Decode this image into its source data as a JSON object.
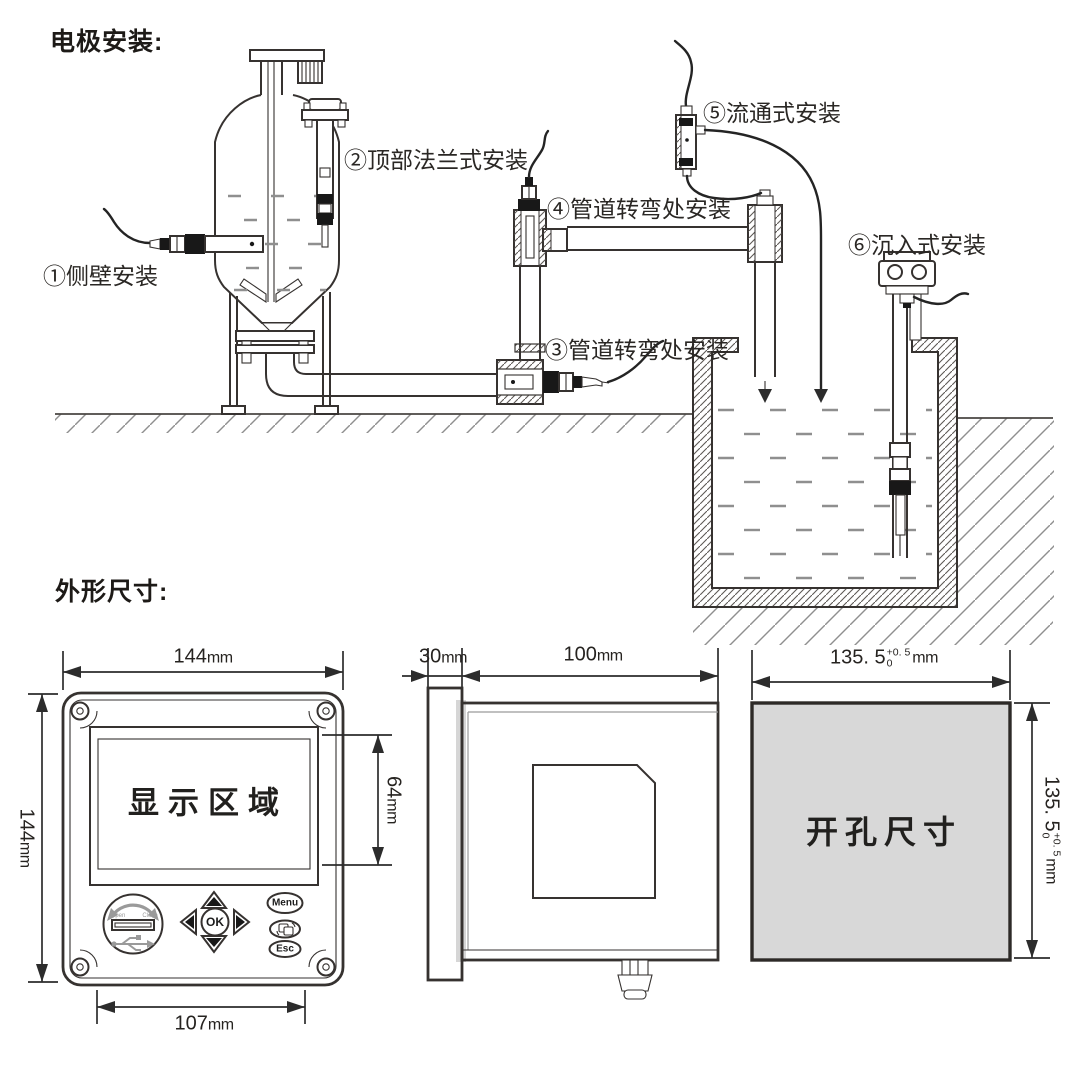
{
  "sections": {
    "electrode_title": "电极安装:",
    "dimensions_title": "外形尺寸:"
  },
  "installation": {
    "labels": {
      "side_wall": "①侧壁安装",
      "top_flange": "②顶部法兰式安装",
      "pipe_bend_lower": "③管道转弯处安装",
      "pipe_bend_upper": "④管道转弯处安装",
      "flow_through": "⑤流通式安装",
      "submersion": "⑥沉入式安装"
    }
  },
  "front_view": {
    "display_label": "显示区域",
    "dims": {
      "width": "144",
      "height": "144",
      "display_height": "64",
      "keypad_width": "107",
      "unit": "mm"
    },
    "buttons": {
      "menu": "Menu",
      "esc": "Esc",
      "ok": "OK"
    },
    "usb": {
      "open": "Open",
      "close": "Close"
    }
  },
  "side_view": {
    "dims": {
      "bezel_depth": "30",
      "body_depth": "100",
      "unit": "mm"
    }
  },
  "cutout_view": {
    "label": "开孔尺寸",
    "dims": {
      "width": "135. 5",
      "height": "135. 5",
      "tol_plus": "+0. 5",
      "tol_minus": "0",
      "unit": "mm"
    }
  },
  "colors": {
    "line": "#363230",
    "cutout_fill": "#d8d8d8",
    "water": "#8f8f8f",
    "hatch": "#8f8f8f"
  }
}
